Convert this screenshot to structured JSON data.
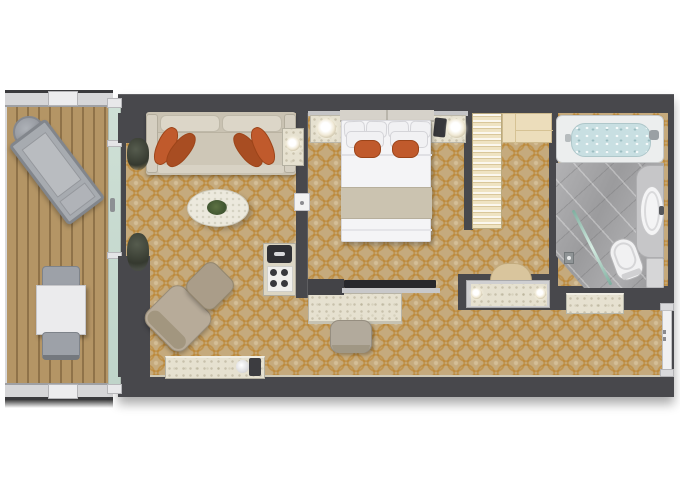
{
  "scene": {
    "kind": "hotel-suite-floorplan",
    "view": "top-down",
    "palette": {
      "page_bg": "#ffffff",
      "wall": "#48484c",
      "carpet_base": "#c5aa7d",
      "carpet_pattern": "#ba8028",
      "deck_wood": "#b49565",
      "glass": "#cfe0d6",
      "marble": "#e6e1d0",
      "sofa": "#c9c2b2",
      "accent_orange": "#c05a2c",
      "accent_orange_dark": "#a84d22",
      "bath_floor": "#a8a8aa",
      "tub_water": "#c8dfe2",
      "closet_wood": "#ecddbb",
      "outdoor_gray": "#9da1a8",
      "fixture_white": "#f2f2f3"
    },
    "rooms": {
      "balcony": {
        "label": "Balcony",
        "items": [
          "railing",
          "round side table",
          "sun lounger",
          "outdoor dining table",
          "two outdoor chairs"
        ]
      },
      "living_room": {
        "label": "Living room",
        "items": [
          "sofa with four orange pillows",
          "side table with lamp",
          "oval marble coffee table with plant",
          "armchair",
          "ottoman",
          "two potted plants",
          "marble sideboard",
          "minibar with coffee machine and cups"
        ]
      },
      "bedroom": {
        "label": "Bedroom",
        "items": [
          "king bed with orange accent pillows",
          "nightstand with lamp (left)",
          "nightstand with lamp and telephone (right)",
          "TV on console wall",
          "marble desk",
          "desk chair"
        ]
      },
      "dressing_area": {
        "label": "Dressing area",
        "items": [
          "hanging wardrobe",
          "cabinets",
          "vanity with two lamps",
          "stool"
        ]
      },
      "bathroom": {
        "label": "Bathroom",
        "items": [
          "bathtub",
          "walk-in shower with glass screen",
          "vanity sink",
          "toilet"
        ]
      },
      "entry_hall": {
        "label": "Entry hall",
        "items": [
          "marble console table",
          "entry door"
        ]
      }
    }
  }
}
